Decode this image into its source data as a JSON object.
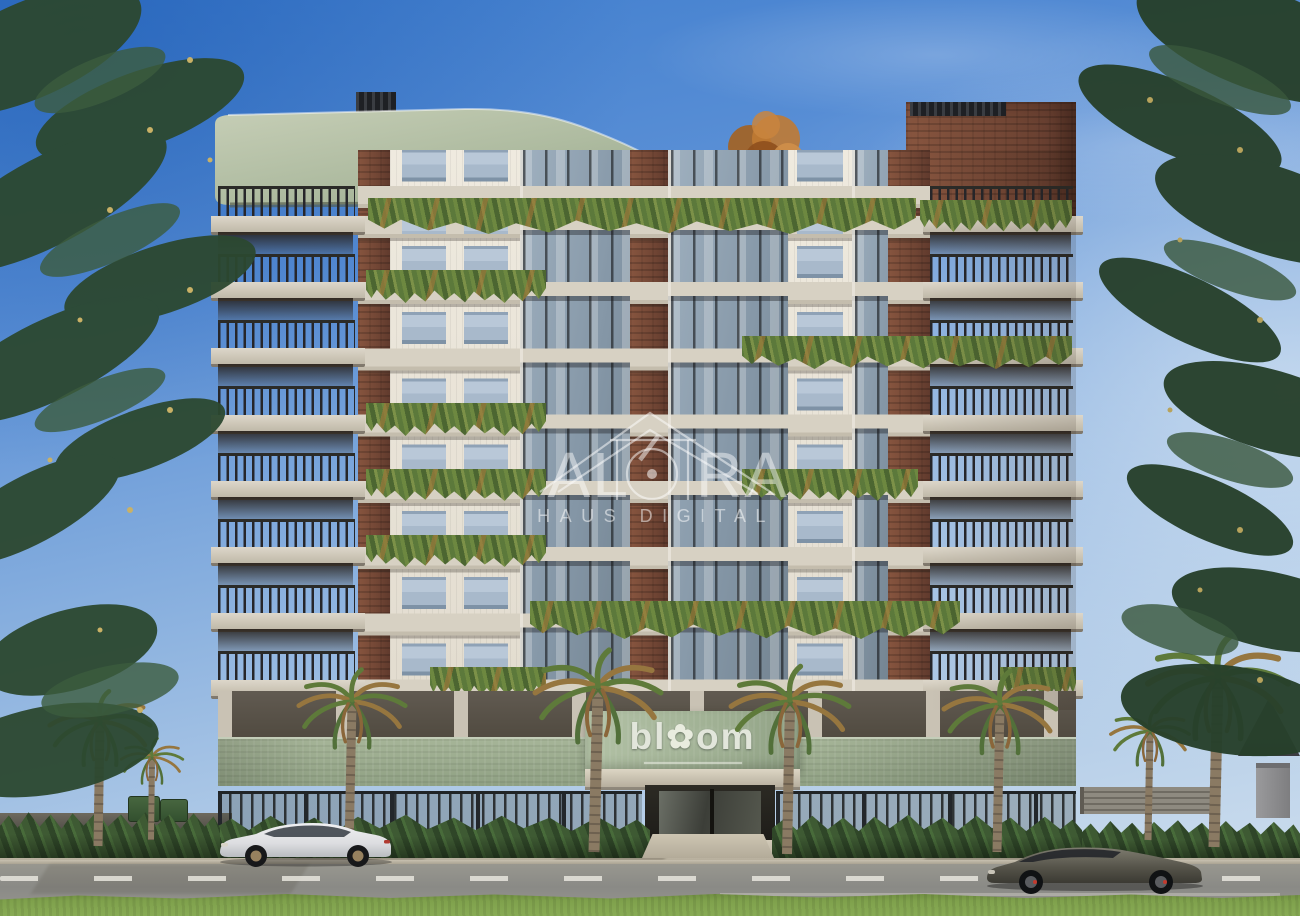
{
  "watermark": {
    "logo_icon": "house-outline-logo",
    "brand_left": "AL",
    "brand_o_icon": "circle-dot-o",
    "brand_right": "RA",
    "brand_full": "ALÓRA",
    "tagline": "HAUS DIGITAL",
    "color": "#FFFFFF",
    "opacity": 0.48
  },
  "sign": {
    "text_left": "bl",
    "flower_icon": "✿",
    "text_right": "om",
    "full_name": "bloom",
    "wall_color": "#9DB08F",
    "text_color": "#E2E6DB"
  },
  "scene": {
    "subject": "residential apartment building exterior render",
    "vehicles_left": "white-sports-sedan",
    "vehicles_right": "dark-sports-coupe",
    "landscaping": [
      "palm-trees",
      "cascading-balcony-plants",
      "hedges",
      "street-lawn"
    ]
  },
  "palette": {
    "sky_top": "#3D7CCD",
    "sky_horizon": "#C6D9EC",
    "canopy_sage": "#AFBCA3",
    "brick": "#7B4B3C",
    "concrete": "#CFC9BD",
    "railing": "#2B2B28",
    "glass": "#9DB2C8",
    "plants_green": "#5E7B3C",
    "plants_autumn": "#A97F3F",
    "entrance_green": "#9DB08F",
    "hedge": "#3C5631",
    "palm_trunk": "#8A7A63",
    "road": "#8F8F8D",
    "grass": "#7FA14C",
    "car_white": "#E3E4E6",
    "car_dark": "#56544A"
  }
}
